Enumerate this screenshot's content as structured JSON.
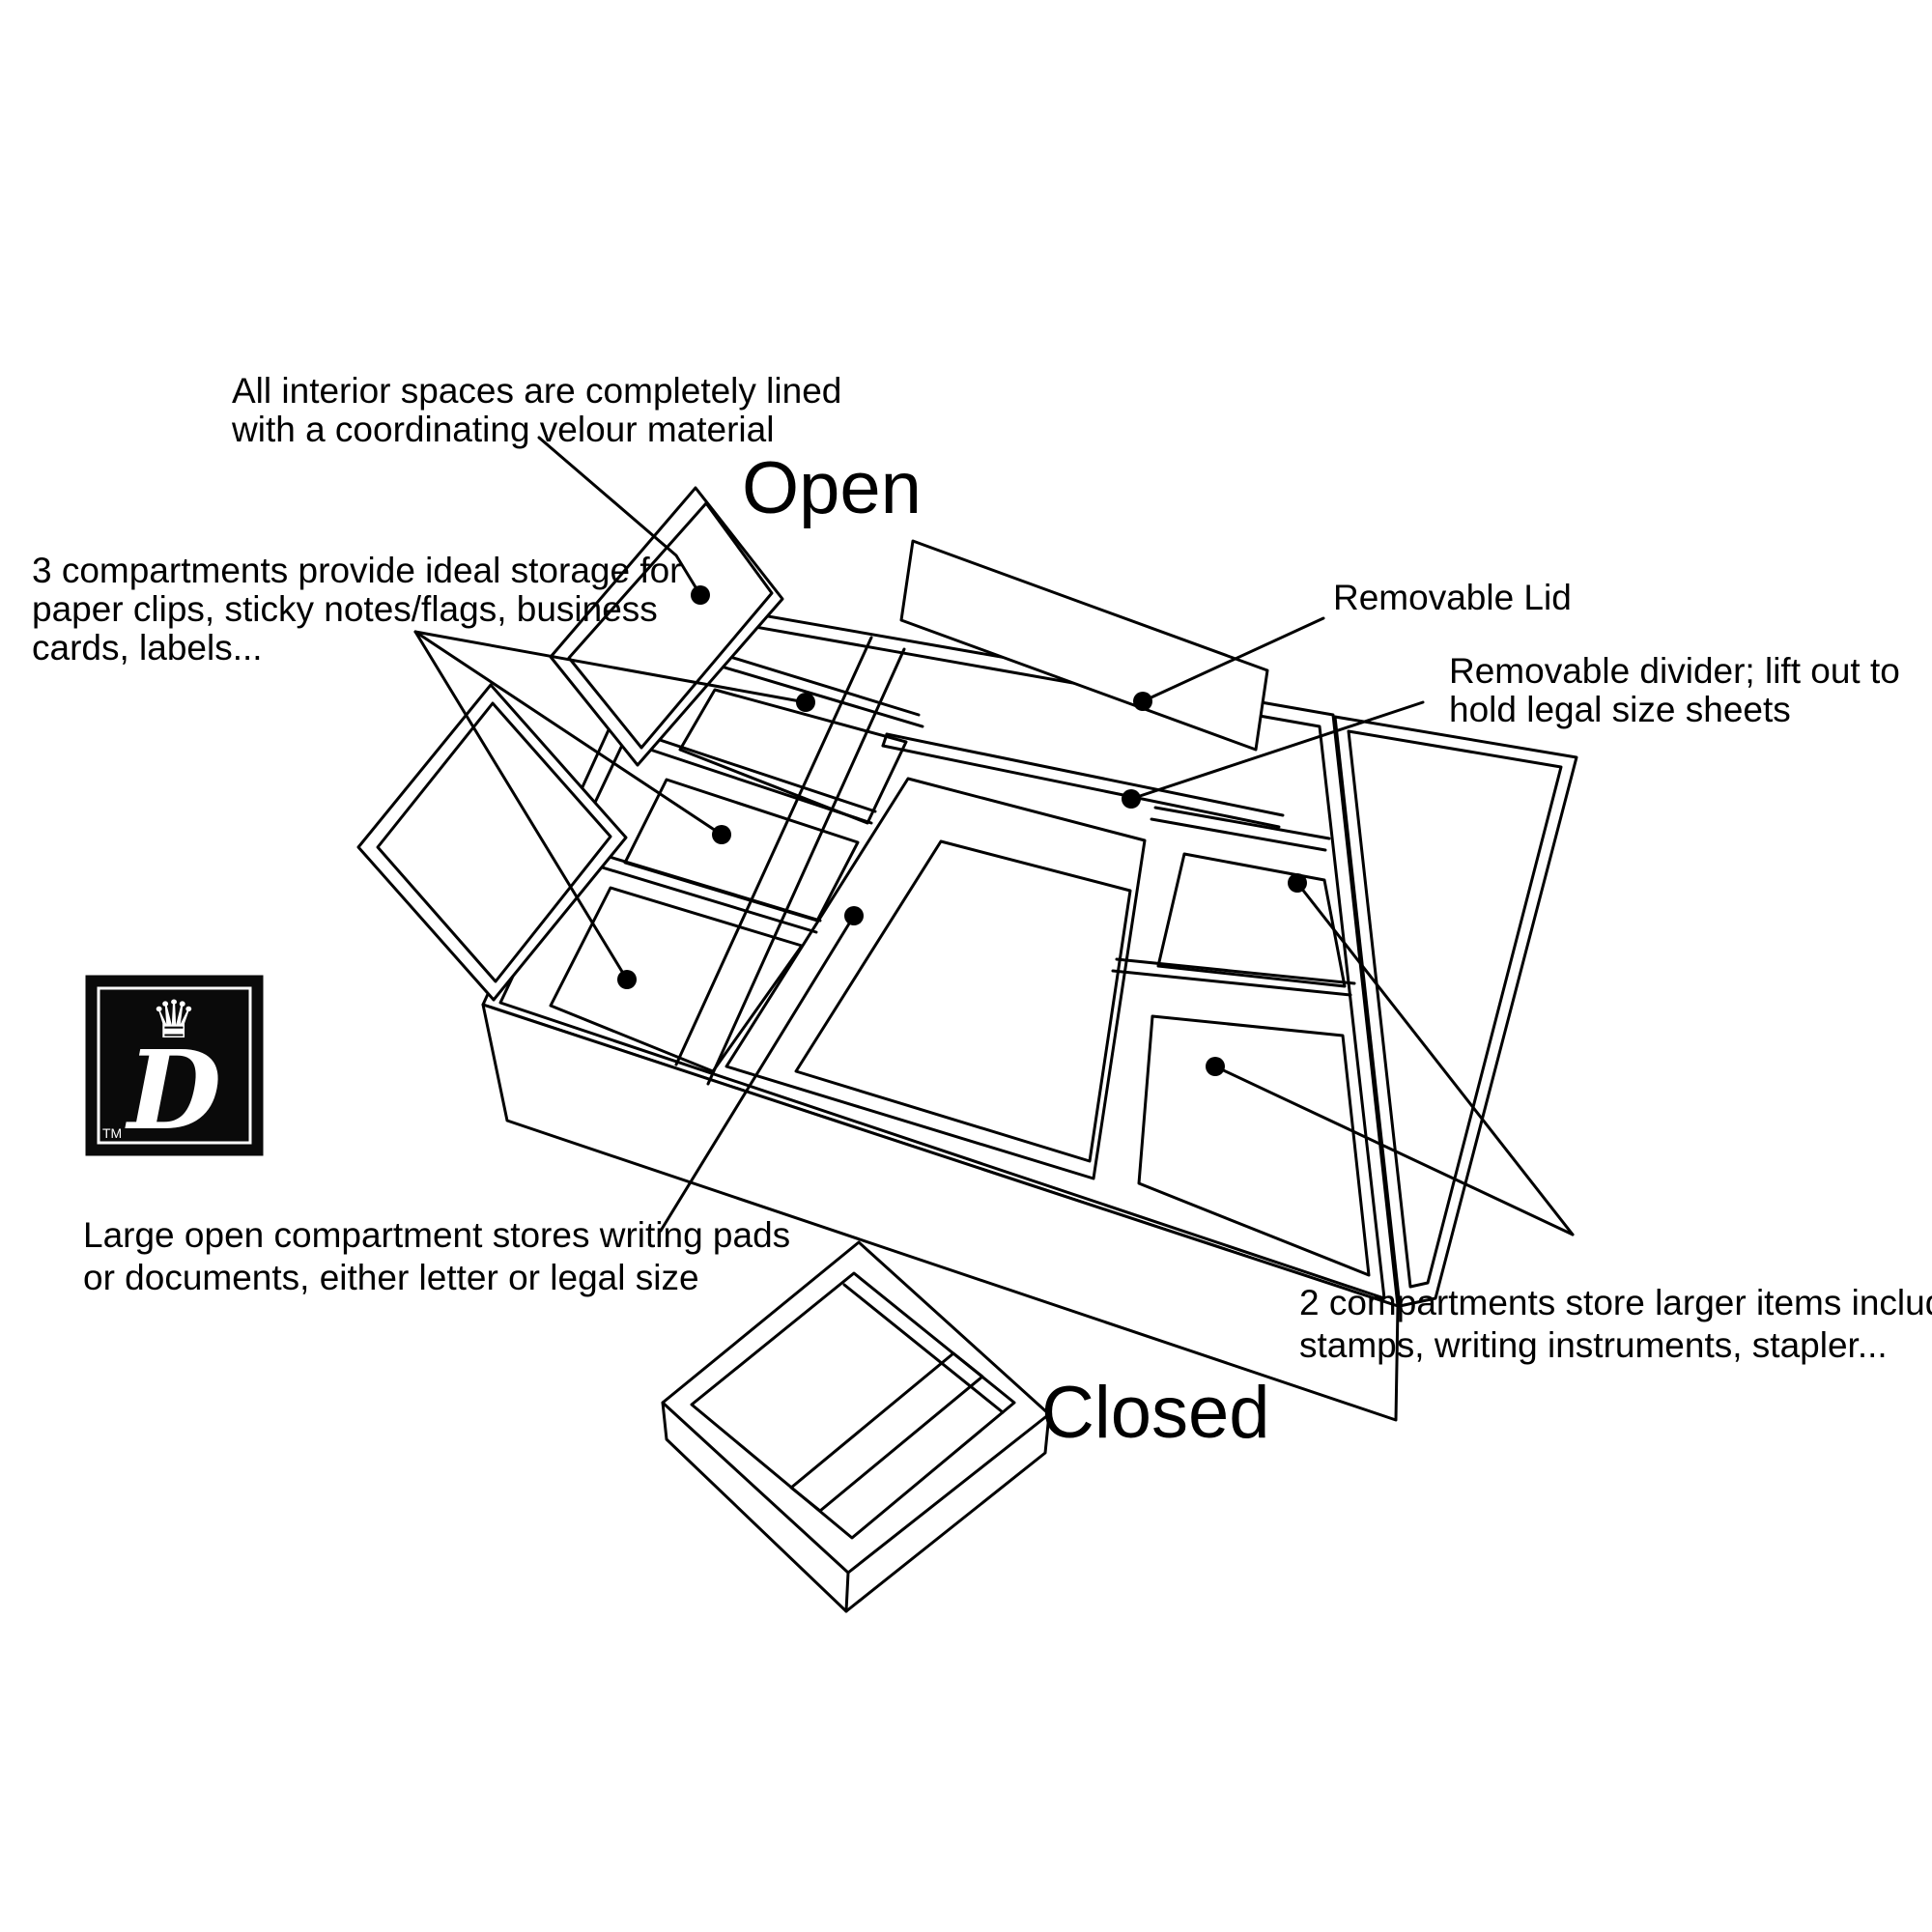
{
  "colors": {
    "ink": "#000000",
    "background": "#ffffff",
    "logo_bg": "#0a0a0a",
    "logo_fg": "#ffffff"
  },
  "titles": {
    "open": "Open",
    "closed": "Closed"
  },
  "annotations": {
    "velour": {
      "lines": [
        "All interior spaces are completely lined",
        "with a coordinating velour material"
      ]
    },
    "compartments3": {
      "lines": [
        "3 compartments provide ideal storage for",
        "paper clips, sticky notes/flags, business",
        "cards, labels..."
      ]
    },
    "removable_lid": {
      "lines": [
        "Removable Lid"
      ]
    },
    "divider": {
      "lines": [
        "Removable divider; lift out to",
        "hold legal size sheets"
      ]
    },
    "large_open": {
      "lines": [
        "Large open compartment stores writing pads",
        "or documents, either letter or legal size"
      ]
    },
    "compartments2": {
      "lines": [
        "2 compartments store larger items including",
        "stamps, writing instruments, stapler..."
      ]
    }
  },
  "logo": {
    "letter": "D",
    "tm": "TM",
    "crown_glyph": "♛"
  }
}
